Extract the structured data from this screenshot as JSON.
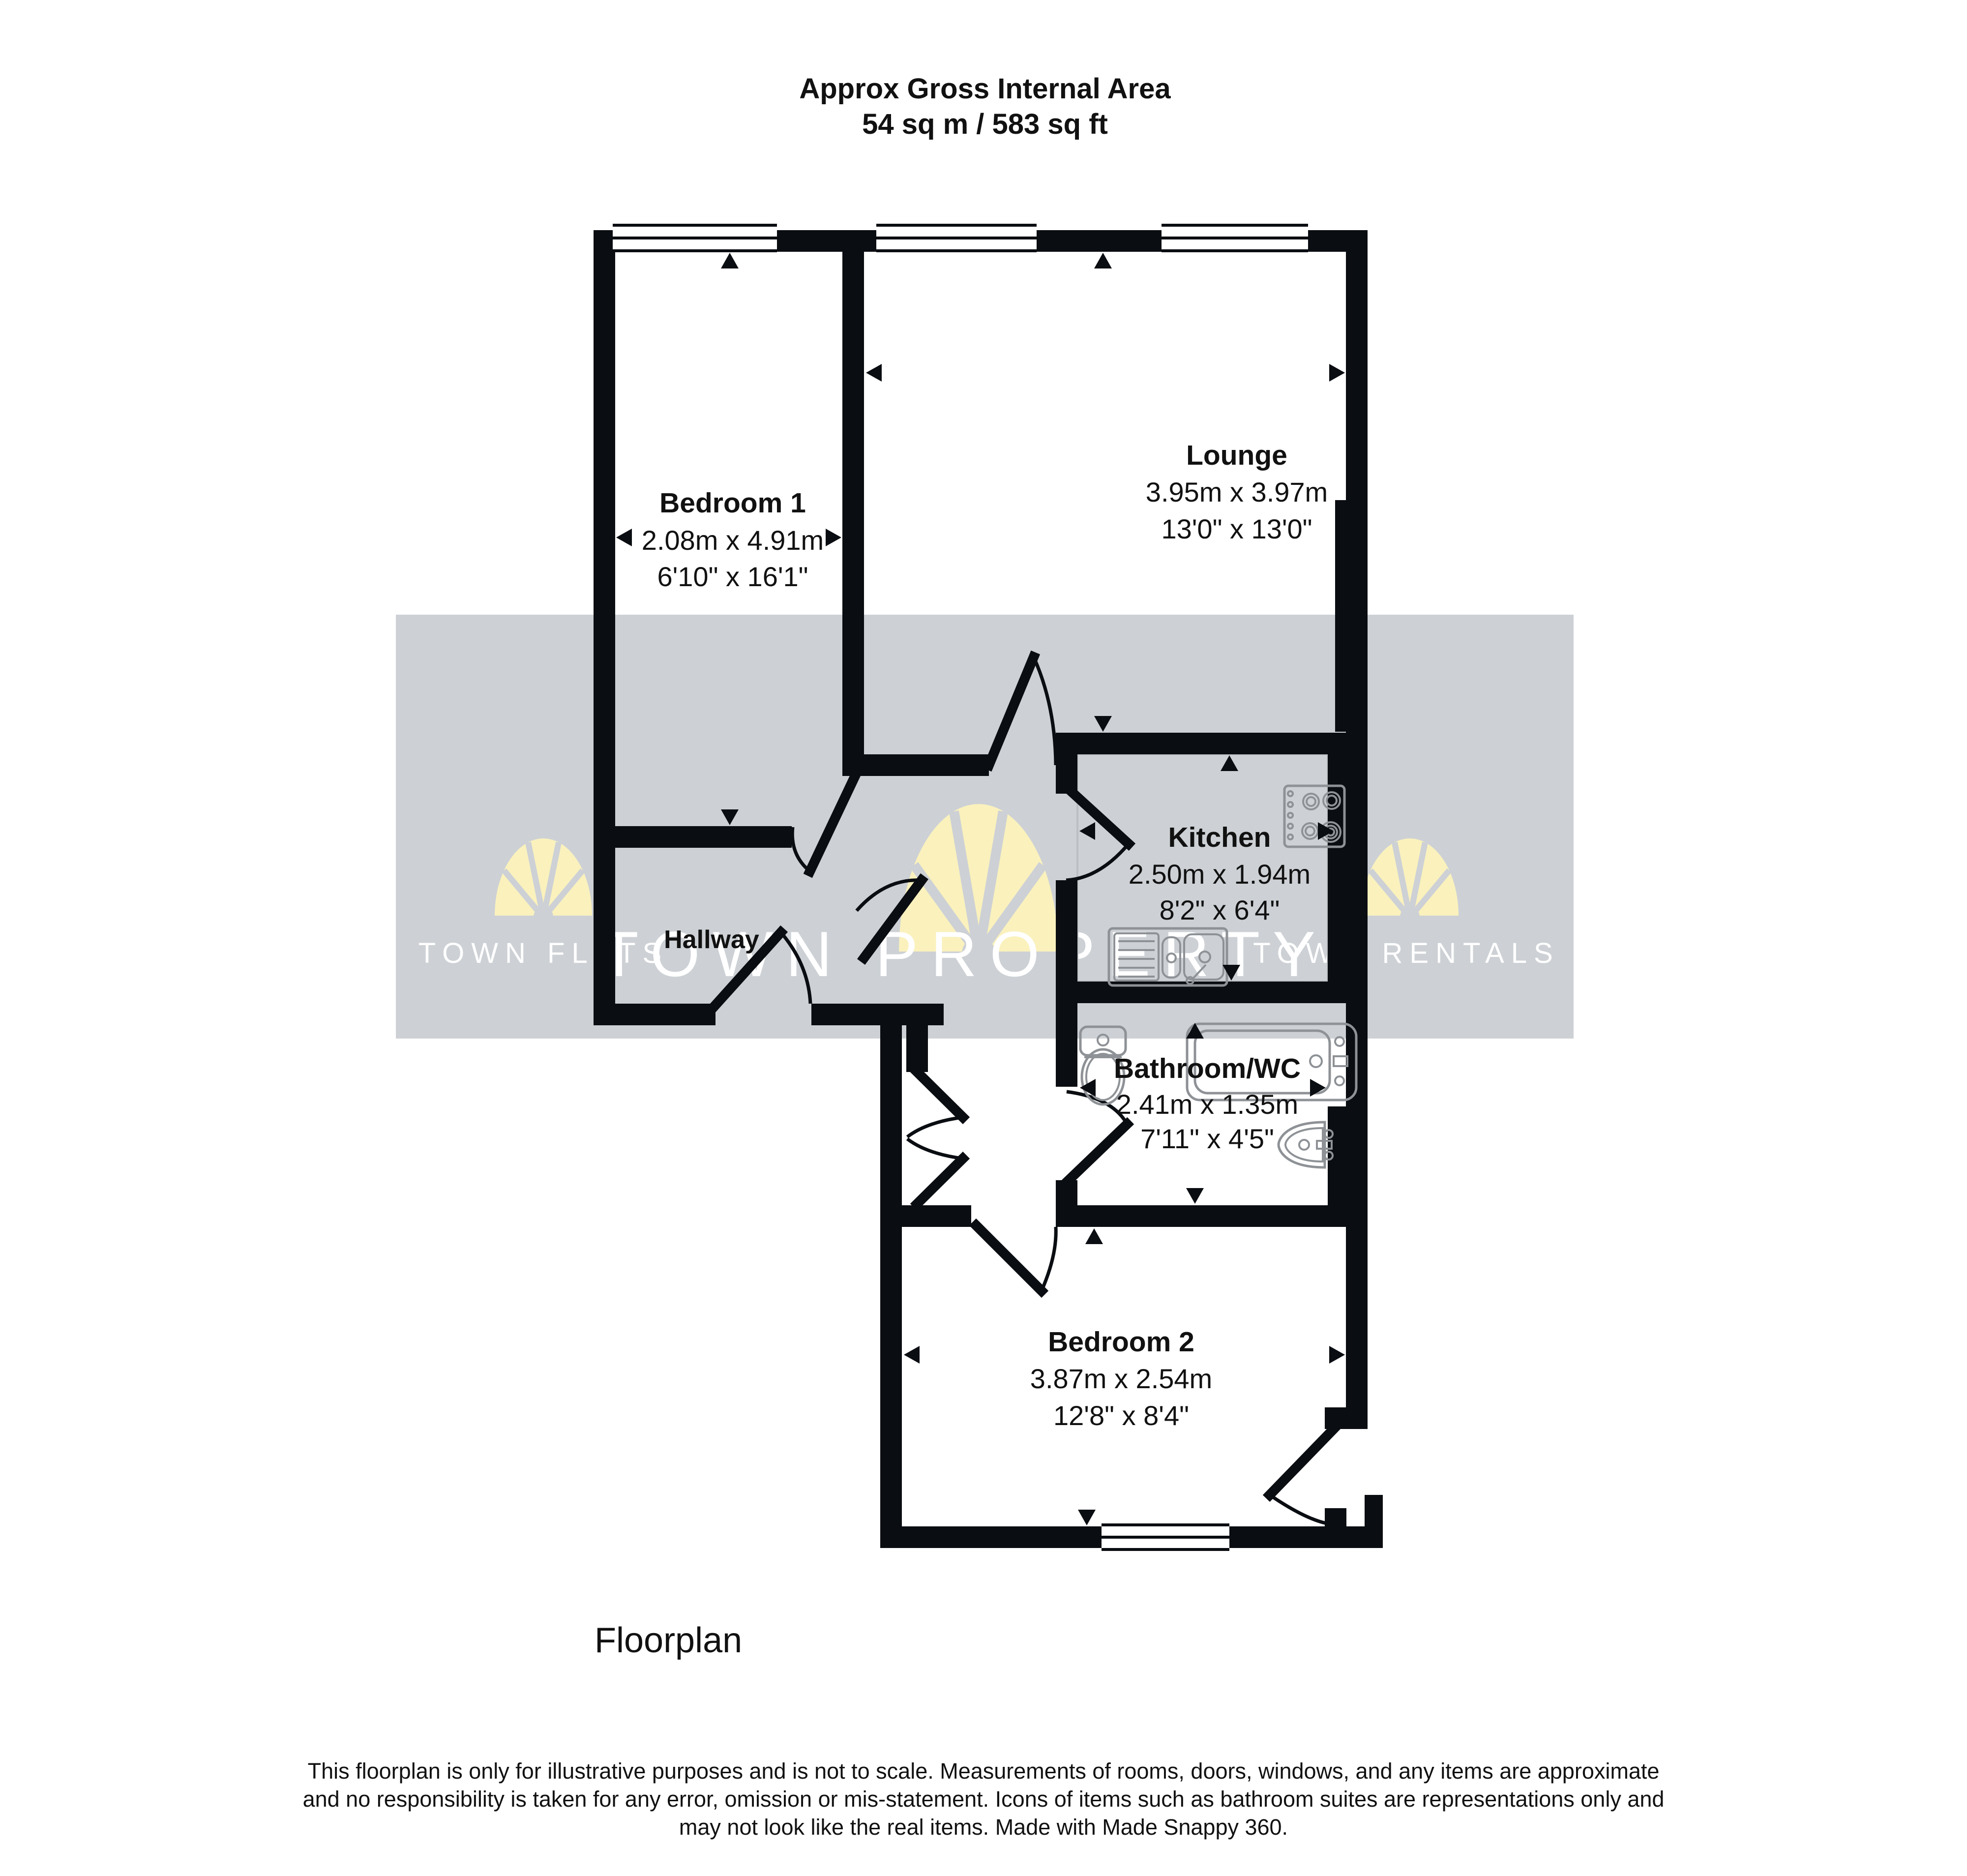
{
  "title": {
    "line1": "Approx Gross Internal Area",
    "line2": "54 sq m / 583 sq ft"
  },
  "rooms": {
    "bedroom1": {
      "name": "Bedroom 1",
      "metric": "2.08m x 4.91m",
      "imperial": "6'10\" x 16'1\""
    },
    "lounge": {
      "name": "Lounge",
      "metric": "3.95m x 3.97m",
      "imperial": "13'0\" x 13'0\""
    },
    "kitchen": {
      "name": "Kitchen",
      "metric": "2.50m x 1.94m",
      "imperial": "8'2\" x 6'4\""
    },
    "hallway": {
      "name": "Hallway"
    },
    "bathroom": {
      "name": "Bathroom/WC",
      "metric": "2.41m x 1.35m",
      "imperial": "7'11\" x 4'5\""
    },
    "bedroom2": {
      "name": "Bedroom 2",
      "metric": "3.87m x 2.54m",
      "imperial": "12'8\" x 8'4\""
    }
  },
  "watermarks": {
    "left": "TOWN FLATS",
    "center": "TOWN PROPERTY",
    "right": "TOWN RENTALS"
  },
  "caption": "Floorplan",
  "disclaimer": {
    "line1": "This floorplan is only for illustrative purposes and is not to scale. Measurements of rooms, doors, windows, and any items are approximate",
    "line2": "and no responsibility is taken for any error, omission or mis-statement. Icons of items such as bathroom suites are representations only and",
    "line3": "may not look like the real items. Made with Made Snappy 360."
  },
  "colors": {
    "wall": "#0a0d11",
    "watermark_band": "#cdd1d5",
    "watermark_fan": "#faf1bd",
    "watermark_text": "#ffffff"
  }
}
